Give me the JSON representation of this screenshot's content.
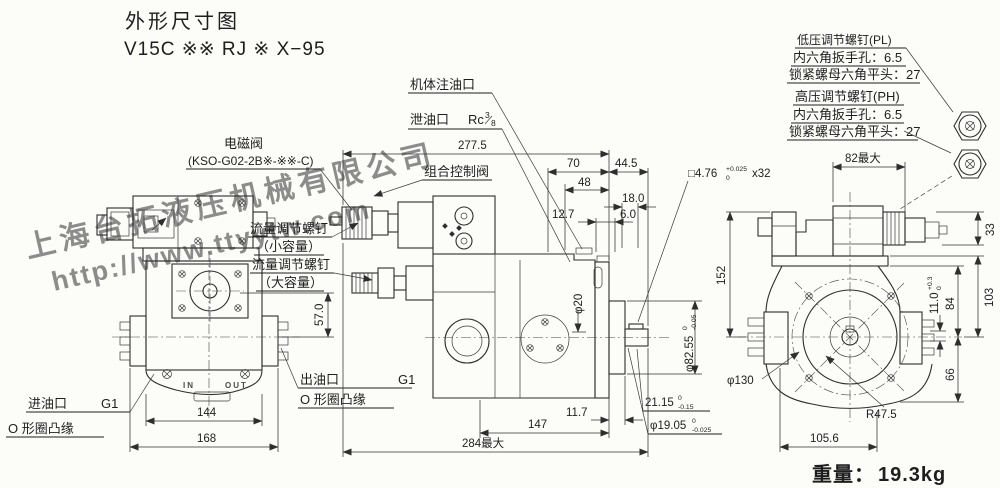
{
  "title": {
    "line1": "外形尺寸图",
    "line2": "V15C ※※ RJ ※ X−95"
  },
  "watermark": {
    "company": "上海台拓液压机械有限公司",
    "url": "http://www.ttyytw.com",
    "color": "#2f55d4"
  },
  "weight": {
    "label": "重量：",
    "value": "19.3kg"
  },
  "callouts": {
    "solenoid_valve": "电磁阀",
    "solenoid_model": "(KSO-G02-2B※-※※-C)",
    "body_fill_port": "机体注油口",
    "drain_port": "泄油口",
    "drain_thread": {
      "base": "Rc",
      "num": "3",
      "den": "8"
    },
    "combined_control_valve": "组合控制阀",
    "flow_small_1": "流量调节螺钉",
    "flow_small_2": "（小容量）",
    "flow_large_1": "流量调节螺钉",
    "flow_large_2": "（大容量）",
    "low_pressure": {
      "line1": "低压调节螺钉(PL)",
      "line2": "内六角扳手孔：6.5",
      "line3": "锁紧螺母六角平头：27"
    },
    "high_pressure": {
      "line1": "高压调节螺钉(PH)",
      "line2": "内六角扳手孔：6.5",
      "line3": "锁紧螺母六角平头：27"
    }
  },
  "ports": {
    "inlet_label": "进油口",
    "inlet_size": "G1",
    "inlet_flange": "O 形圈凸缘",
    "outlet_label": "出油口",
    "outlet_size": "G1",
    "outlet_flange": "O 形圈凸缘",
    "cast_in": "IN",
    "cast_out": "OUT"
  },
  "dims": {
    "overall_top": "277.5",
    "d70": "70",
    "d48": "48",
    "d44_5": "44.5",
    "d18": "18.0",
    "d12_7": "12.7",
    "d6": "6.0",
    "d57": "57.0",
    "shaft_boss_dia": "φ20",
    "spigot": {
      "main": "φ82.55",
      "tol_top": "0",
      "tol_bot": "-0.05"
    },
    "key": {
      "main": "□4.76",
      "tol_top": "+0.025",
      "tol_bot": "0",
      "suffix": "x32"
    },
    "key_flat": {
      "main": "21.15",
      "tol_top": "0",
      "tol_bot": "-0.15"
    },
    "shaft_dia": {
      "main": "φ19.05",
      "tol_top": "0",
      "tol_bot": "-0.025"
    },
    "d147": "147",
    "d11_7": "11.7",
    "overall_bottom": "284最大",
    "d144": "144",
    "d168": "168",
    "d82max": "82最大",
    "d33": "33",
    "d152": "152",
    "d103": "103",
    "d84": "84",
    "boss_step": {
      "main": "11.0",
      "tol_top": "+0.3",
      "tol_bot": "0"
    },
    "d66": "66",
    "mount_dia": "φ130",
    "r_body": "R47.5",
    "d105_6": "105.6"
  }
}
